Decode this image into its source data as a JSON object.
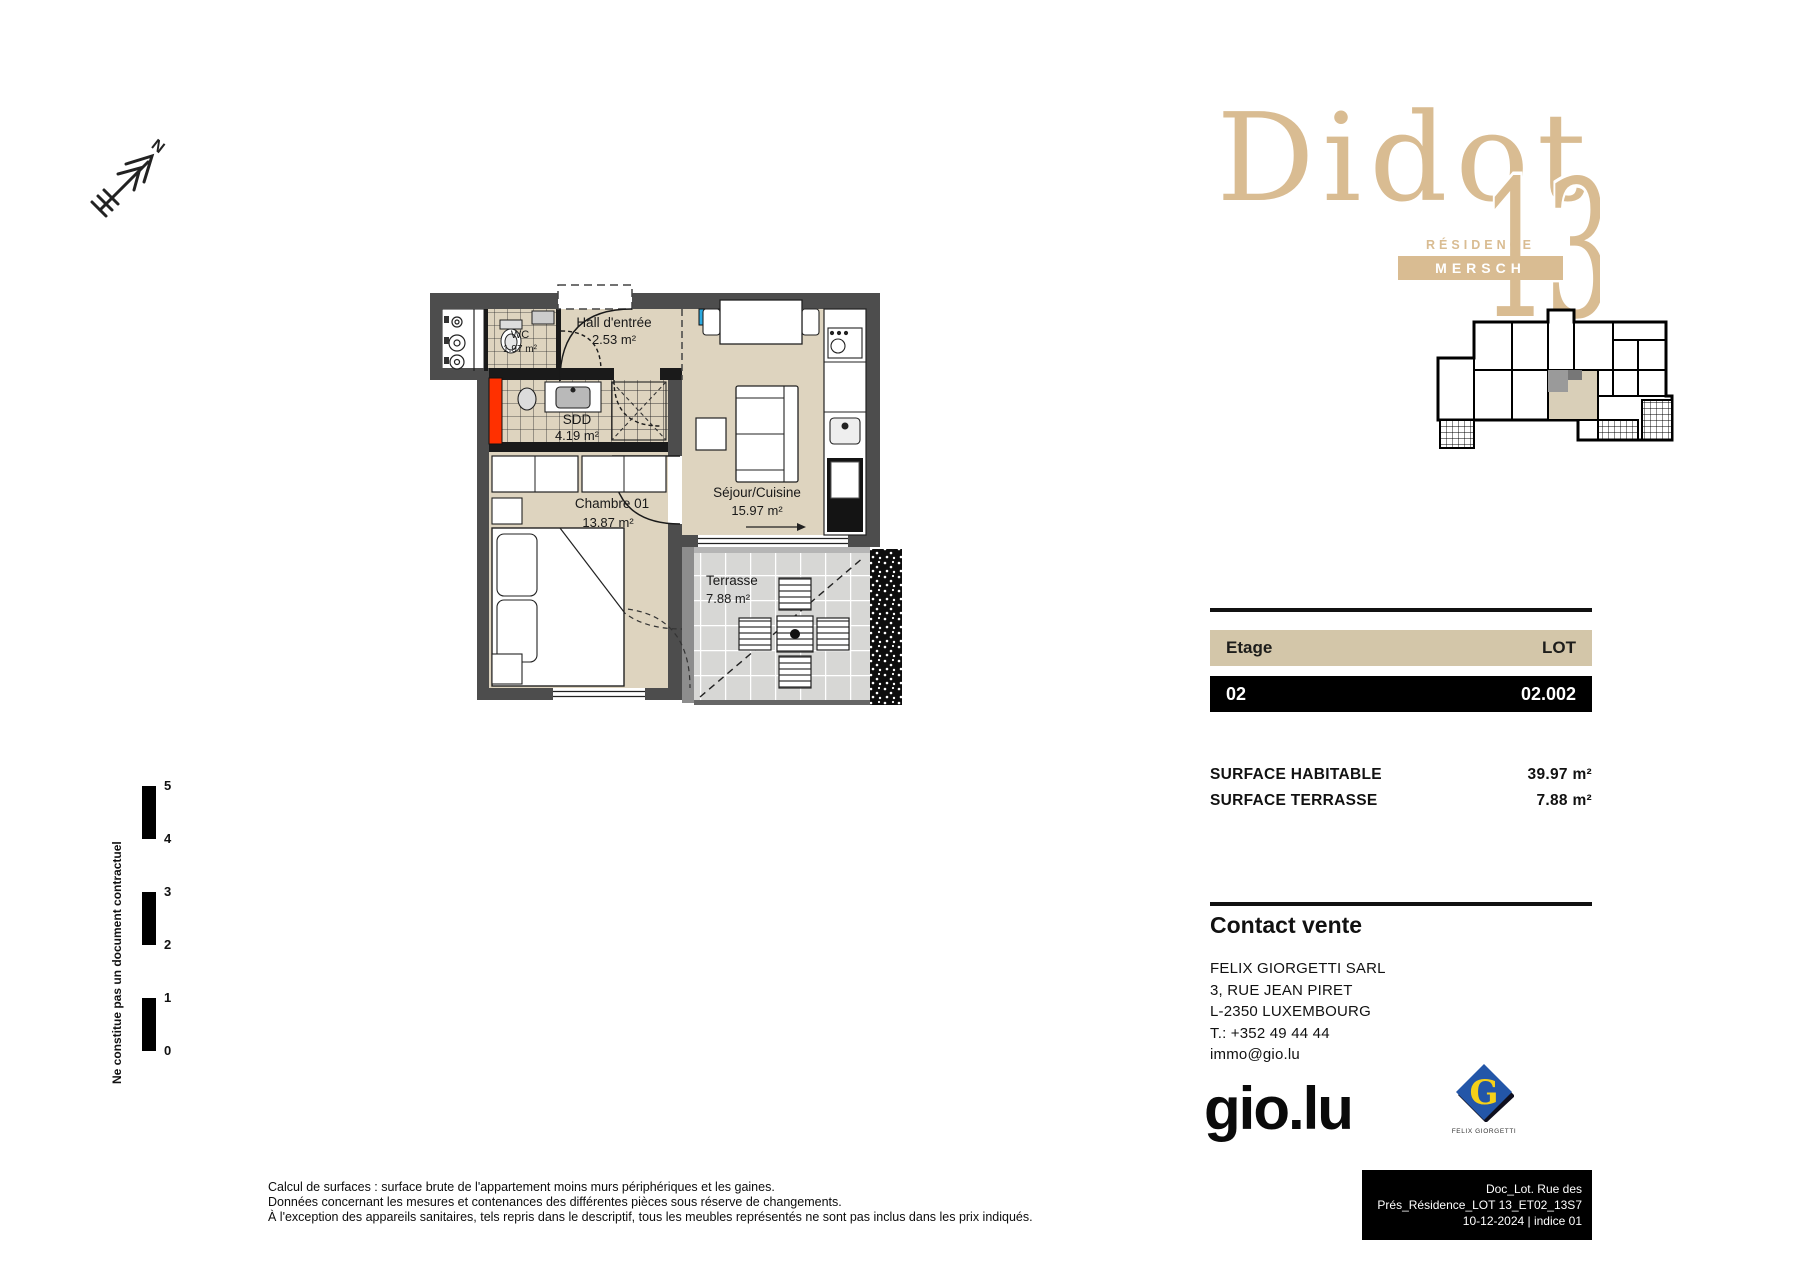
{
  "page": {
    "background": "#ffffff"
  },
  "logo": {
    "name": "Didot",
    "number": "13",
    "residence": "RÉSIDENCE",
    "city": "MERSCH",
    "color": "#d9bc92"
  },
  "north": {
    "label": "N"
  },
  "plan": {
    "rooms": [
      {
        "name": "WC",
        "area": "1.97 m²"
      },
      {
        "name": "Hall d'entrée",
        "area": "2.53 m²"
      },
      {
        "name": "SDD",
        "area": "4.19 m²"
      },
      {
        "name": "Chambre 01",
        "area": "13.87 m²"
      },
      {
        "name": "Séjour/Cuisine",
        "area": "15.97 m²"
      },
      {
        "name": "Terrasse",
        "area": "7.88 m²"
      }
    ],
    "colors": {
      "floor": "#ded4bf",
      "wall": "#4d4d4d",
      "terrace_tile": "#d7d7d5",
      "duct_red": "#ff3000",
      "electric_blue": "#2aa9e0"
    }
  },
  "unit": {
    "etage_label": "Etage",
    "lot_label": "LOT",
    "etage": "02",
    "lot": "02.002",
    "header_bg": "#d3c6a9"
  },
  "surfaces": [
    {
      "label": "SURFACE HABITABLE",
      "value": "39.97 m²"
    },
    {
      "label": "SURFACE TERRASSE",
      "value": "7.88 m²"
    }
  ],
  "contact": {
    "title": "Contact vente",
    "company": "FELIX GIORGETTI SARL",
    "address1": "3, RUE JEAN PIRET",
    "address2": "L-2350 LUXEMBOURG",
    "phone": "T.: +352 49 44 44",
    "email": "immo@gio.lu"
  },
  "brand": {
    "gio": "gio.lu",
    "giorgetti_initial": "G",
    "giorgetti_caption": "FELIX GIORGETTI",
    "blue": "#2356a8",
    "yellow": "#f5d018"
  },
  "docbox": {
    "line1": "Doc_Lot. Rue des Prés_Résidence_LOT 13_ET02_13S7",
    "line2": "10-12-2024 | indice 01"
  },
  "scale": {
    "labels": [
      "5",
      "4",
      "3",
      "2",
      "1",
      "0"
    ]
  },
  "side_note": "Ne constitue pas un document contractuel",
  "disclaimer": {
    "line1": "Calcul de surfaces : surface brute de l'appartement moins murs périphériques et les gaines.",
    "line2": "Données concernant les mesures et contenances des différentes pièces sous réserve de changements.",
    "line3": "À l'exception des appareils sanitaires, tels repris dans le descriptif, tous les meubles représentés ne sont pas inclus dans les prix indiqués."
  }
}
